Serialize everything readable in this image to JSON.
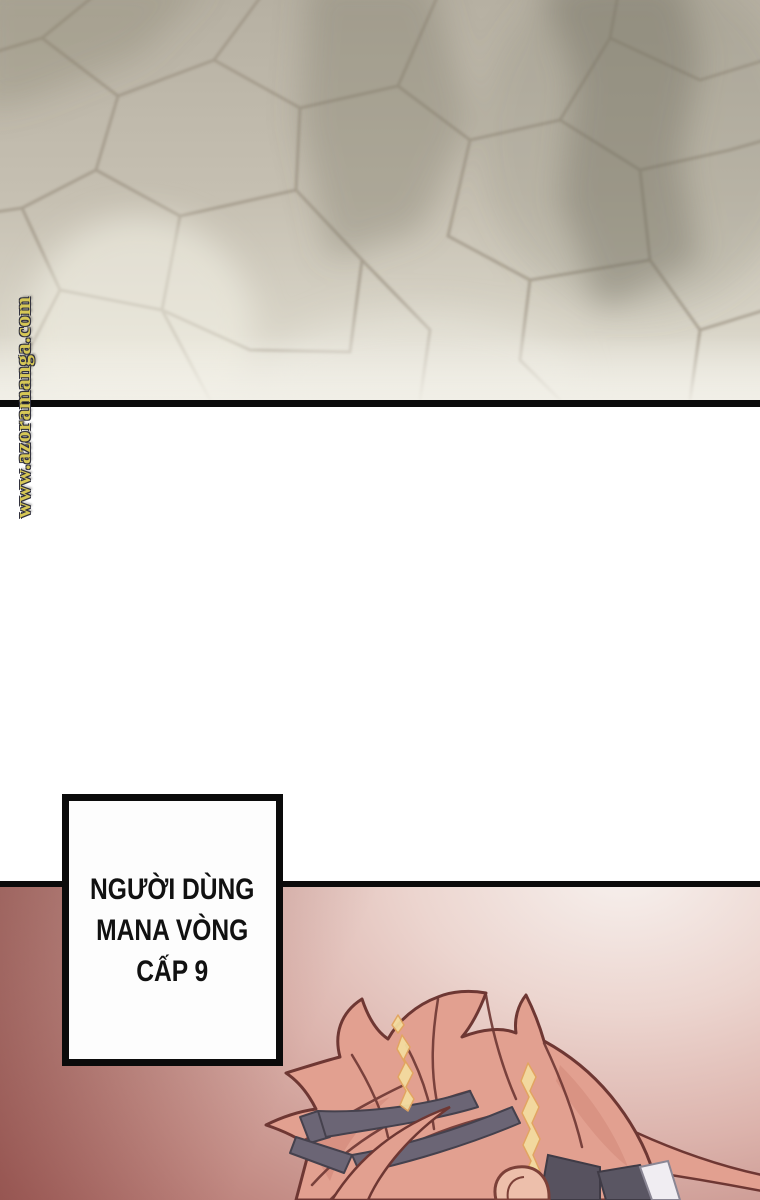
{
  "watermark": {
    "text": "www.azoramanga.com"
  },
  "dialogue": {
    "lines": [
      "NGƯỜI DÙNG",
      "MANA VÒNG",
      "CẤP 9"
    ]
  },
  "colors": {
    "panel_line": "#0b0b0b",
    "text_ink": "#111111",
    "wm_fill": "#d6c756",
    "wm_outline": "#32323e",
    "red_deep": "#81423d",
    "red_light": "#f7f1ee",
    "stone_base": "#c3bdaf",
    "stone_mortar": "#9a9080",
    "hair": "#e2a090",
    "hair_outline": "#6e3733",
    "hair_highlight": "#f3dc9f",
    "strap": "#6b6575",
    "skin": "#edbfab"
  }
}
